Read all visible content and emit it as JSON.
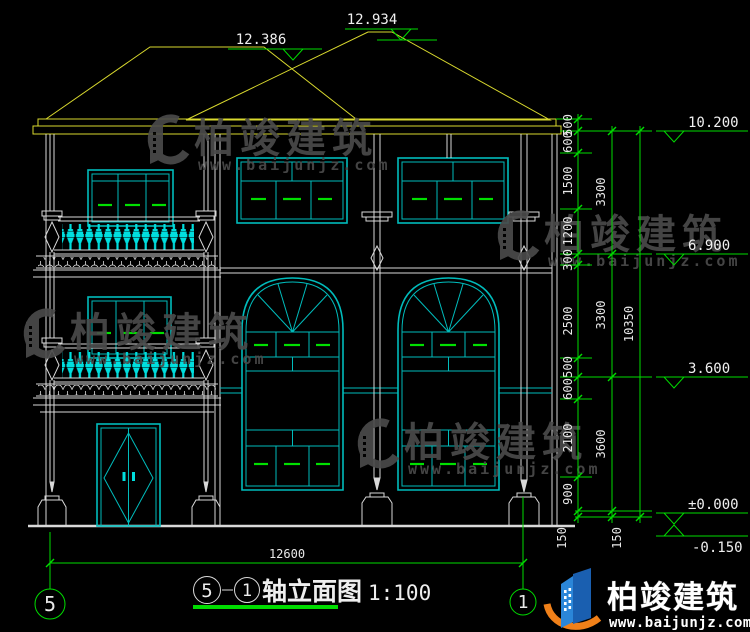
{
  "page": {
    "background": "#000000"
  },
  "title_block": {
    "axis_start": "5",
    "separator": "-",
    "axis_end": "1",
    "name": "轴立面图",
    "scale": "1:100"
  },
  "axis_bubbles": {
    "left": "5",
    "right": "1"
  },
  "dimensions": {
    "top_elevations": {
      "main_ridge": "12.934",
      "secondary_ridge": "12.386"
    },
    "right_chain_inner": [
      "500",
      "600",
      "1500",
      "1200",
      "300",
      "2500",
      "500",
      "600",
      "2100",
      "900",
      "150"
    ],
    "right_chain_middle": [
      "3300",
      "3300",
      "3600",
      "150"
    ],
    "right_chain_total": "10350",
    "right_elevations": {
      "eave": "10.200",
      "floor3": "6.900",
      "floor2": "3.600",
      "ground": "±0.000",
      "site": "-0.150"
    },
    "bottom_width": "12600"
  },
  "watermark": {
    "brand": "柏竣建筑",
    "url": "www.baijunjz.com"
  },
  "logo": {
    "brand": "柏竣建筑",
    "url": "www.baijunjz.com"
  },
  "colors": {
    "line_green": "#00dd00",
    "line_yellow": "#d9d92e",
    "line_cyan": "#00bcbc",
    "line_white": "#d9d9d9",
    "dash_green": "#00e000",
    "watermark_gray": "#4b4b4b",
    "logo_blue": "#1a5fb0",
    "logo_orange": "#f08019"
  }
}
